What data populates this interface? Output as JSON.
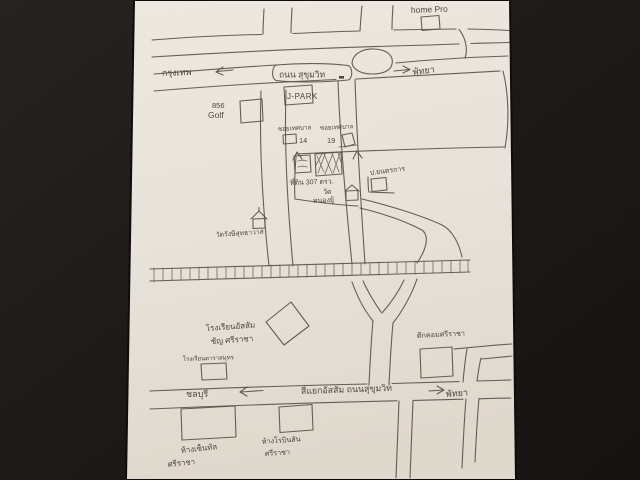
{
  "scene": {
    "description": "photo of a hand-drawn street map sketch on paper",
    "background_color": "#1f1d1b",
    "paper_color": "#efe9e1",
    "ink_color": "#5a534b"
  },
  "top_area": {
    "home_pro": "home Pro",
    "bangkok_left": "กรุงเทพ",
    "sukhumvit_bubble": "ถนน สุขุมวิท",
    "pattaya_right": "พัทยา",
    "jpark": "J-PARK",
    "golf_line1": "856",
    "golf_line2": "Golf",
    "soi14_name": "ซอยเทศบาล",
    "soi14_no": "14",
    "soi19_name": "ซอยเทศบาล",
    "soi19_no": "19"
  },
  "center_area": {
    "land_line1": "ที่ดิน 307 ตรว.",
    "land_line2": "วัด",
    "land_line3": "หนองยู้",
    "garage": "ป.ยนตรการ",
    "temple": "วัดรังษีสุทธาวาส"
  },
  "bottom_area": {
    "school_assumption_line1": "โรงเรียนอัสสัม",
    "school_assumption_line2": "ชัญ ศรีราชา",
    "school_darasamut": "โรงเรียนดาราสมุทร",
    "tukcom": "ตึกคอมศรีราชา",
    "chonburi_left": "ชลบุรี",
    "intersection": "สี่แยกอัสสัม ถนนสุขุมวิท",
    "pattaya_right": "พัทยา",
    "mall_central_line1": "ห้างเซ็นทัล",
    "mall_central_line2": "ศรีราชา",
    "mall_robinson_line1": "ห้างโรบินสัน",
    "mall_robinson_line2": "ศรีราชา"
  }
}
